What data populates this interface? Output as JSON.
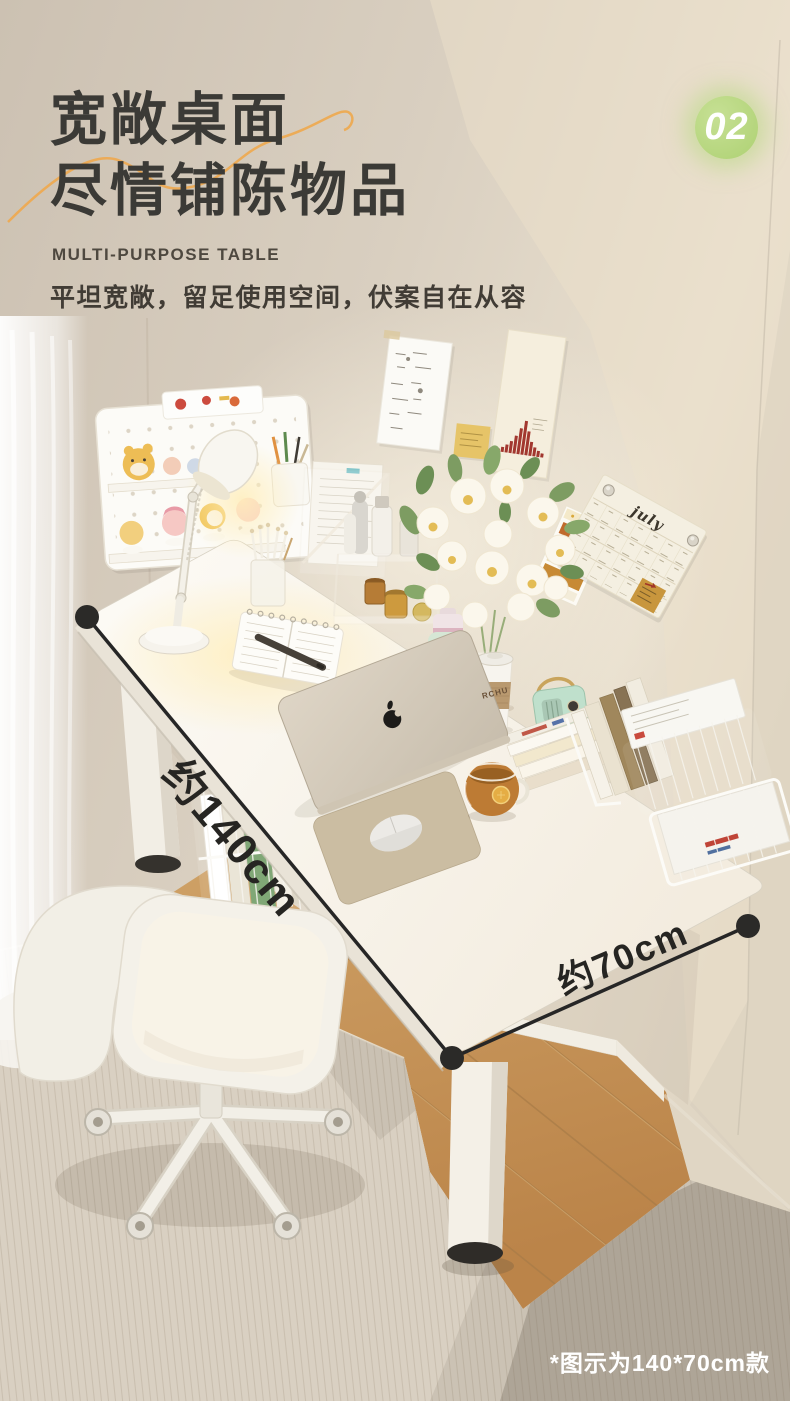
{
  "page": {
    "width": 790,
    "height": 1401
  },
  "header": {
    "section_number": "02",
    "title_line1": "宽敞桌面",
    "title_line2": "尽情铺陈物品",
    "subtitle_en": "MULTI-PURPOSE TABLE",
    "description": "平坦宽敞，留足使用空间，伏案自在从容"
  },
  "measurements": {
    "length": "约140cm",
    "depth": "约70cm"
  },
  "footnote": "*图示为140*70cm款",
  "scene": {
    "calendar_month": "july",
    "cup_sleeve_text": "RCHU"
  },
  "colors": {
    "badge_green": "#b6d77f",
    "accent_orange": "#edaa52",
    "headline": "#3b3a36",
    "wall_beige": "#d5cabc",
    "desk_white": "#faf7f1",
    "wood_floor": "#c89a5e",
    "rug_beige": "#d9d0c2",
    "annotation_dark": "#2b2a28"
  }
}
